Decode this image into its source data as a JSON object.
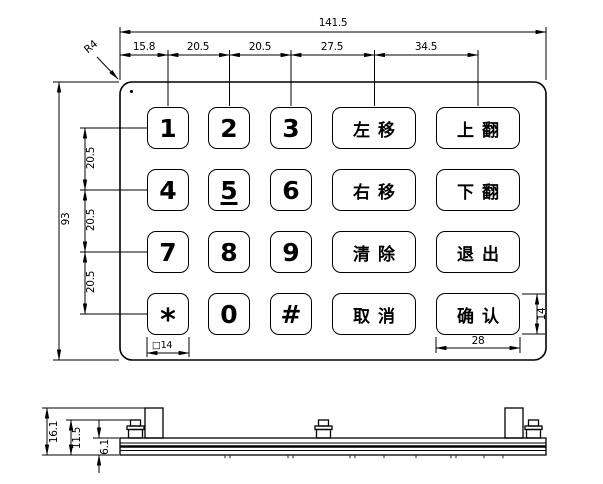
{
  "keypad": {
    "rows": [
      [
        "1",
        "2",
        "3",
        "左移",
        "上翻"
      ],
      [
        "4",
        "5",
        "6",
        "右移",
        "下翻"
      ],
      [
        "7",
        "8",
        "9",
        "清除",
        "退出"
      ],
      [
        "*",
        "0",
        "#",
        "取消",
        "确认"
      ]
    ],
    "underlined_key": "5"
  },
  "dims": {
    "top_total": "141.5",
    "top_segments": [
      "15.8",
      "20.5",
      "20.5",
      "27.5",
      "34.5"
    ],
    "left_total": "93",
    "left_row_pitch": [
      "20.5",
      "20.5",
      "20.5"
    ],
    "corner_radius": "R4",
    "key_size": "□14",
    "confirm_key_width": "28",
    "confirm_key_height": "14",
    "side_view": {
      "overall_height": "16.1",
      "stud_height": "11.5",
      "plate_thickness": "6.1"
    }
  }
}
